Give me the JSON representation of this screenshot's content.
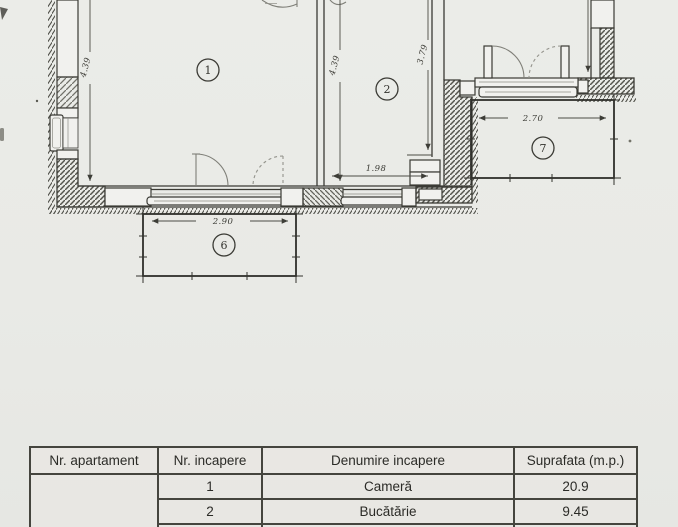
{
  "floorplan": {
    "rooms": [
      {
        "number": "1"
      },
      {
        "number": "2"
      },
      {
        "number": "6"
      },
      {
        "number": "7"
      }
    ],
    "dimensions": {
      "left_height": "4.39",
      "middle_height": "4.39",
      "right_height": "3.79",
      "kitchen_width": "1.98",
      "balcony6_width": "2.90",
      "balcony7_width": "2.70"
    }
  },
  "table": {
    "headers": [
      "Nr. apartament",
      "Nr. incapere",
      "Denumire incapere",
      "Suprafata (m.p.)"
    ],
    "apartment_cell": "",
    "rows": [
      [
        "1",
        "Cameră",
        "20.9"
      ],
      [
        "2",
        "Bucătărie",
        "9.45"
      ],
      [
        "",
        "",
        ""
      ]
    ]
  }
}
